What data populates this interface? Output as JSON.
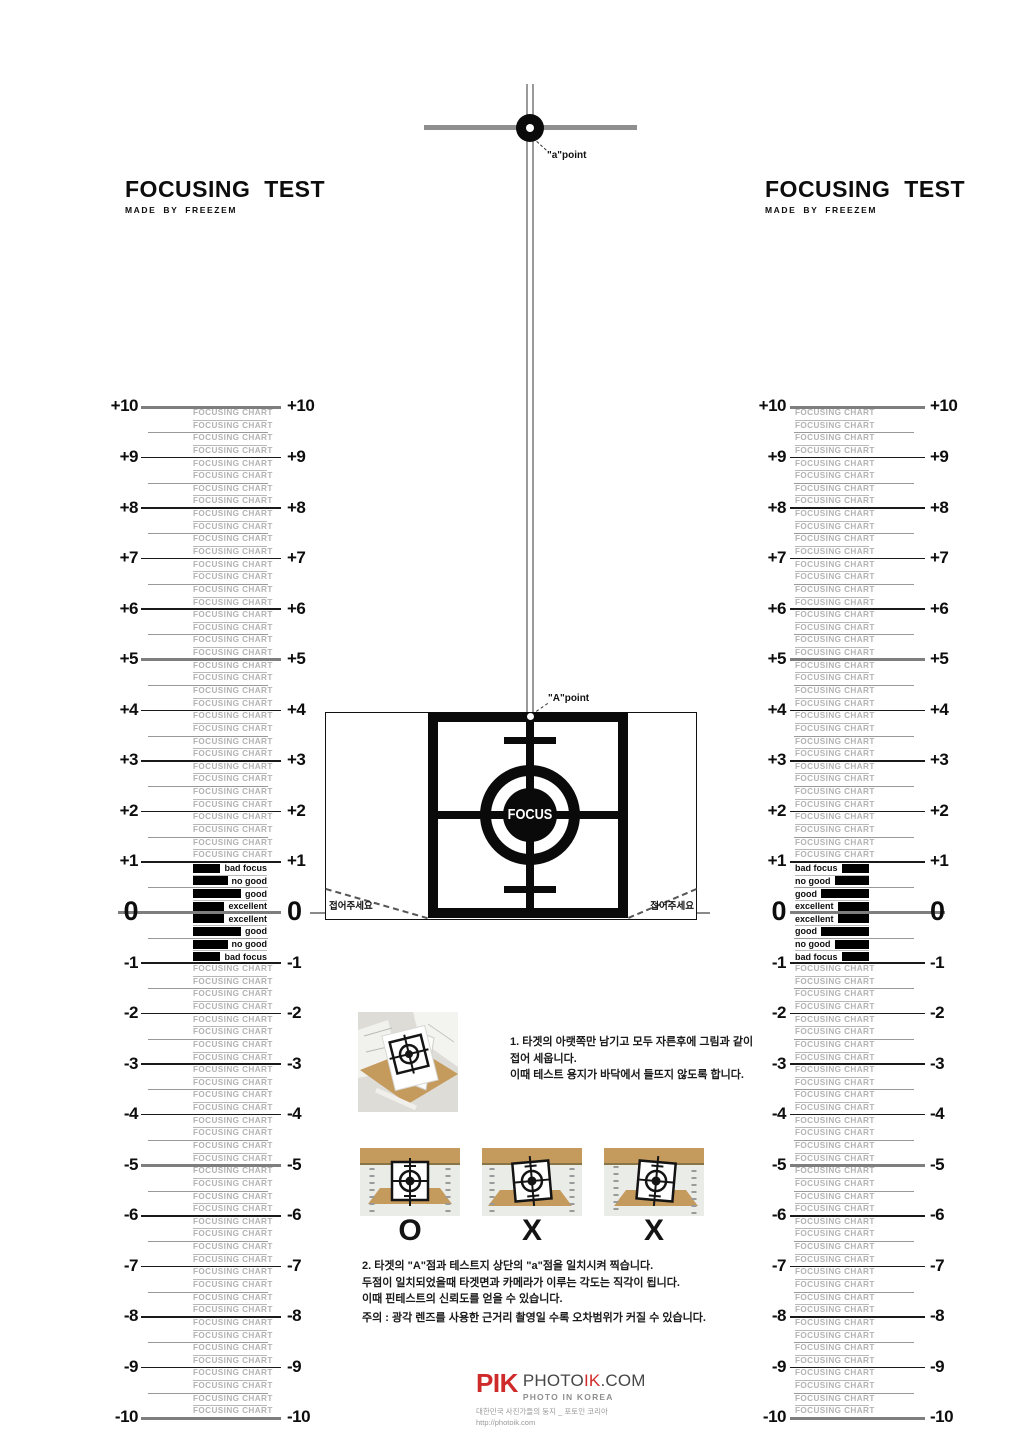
{
  "page": {
    "bg": "#ffffff"
  },
  "header_left": {
    "title": "FOCUSING TEST",
    "subtitle": "MADE BY FREEZEM"
  },
  "header_right": {
    "title": "FOCUSING TEST",
    "subtitle": "MADE BY FREEZEM"
  },
  "crosshair": {
    "label": "\"a\"point"
  },
  "target": {
    "a_point_label": "\"A\"point",
    "focus_label": "FOCUS",
    "fold_label_left": "접어주세요",
    "fold_label_right": "접어주세요"
  },
  "ruler": {
    "max": 10,
    "min": -10,
    "filler_text": "FOCUSING CHART",
    "zero_labels": [
      "bad focus",
      "no good",
      "good",
      "excellent",
      "excellent",
      "good",
      "no good",
      "bad focus"
    ]
  },
  "instructions": {
    "step1_lines": [
      "1. 타겟의 아랫쪽만 남기고 모두 자른후에 그림과 같이",
      "접어 세웁니다.",
      "이때 테스트 용지가 바닥에서 들뜨지 않도록 합니다."
    ],
    "step2_lines": [
      "2. 타겟의 \"A\"점과 테스트지 상단의 \"a\"점을 일치시켜 찍습니다.",
      "두점이 일치되었을때 타겟면과 카메라가 이루는 각도는 직각이 됩니다.",
      "이때 핀테스트의 신뢰도를 얻을 수 있습니다."
    ],
    "warning": "주의 : 광각 렌즈를 사용한 근거리 촬영일 수록 오차범위가 커질 수 있습니다."
  },
  "examples": {
    "labels": [
      "O",
      "X",
      "X"
    ]
  },
  "logo": {
    "pik": "PIK",
    "brand_prefix": "PHOTO",
    "brand_mid": "IK",
    "brand_suffix": ".COM",
    "tagline": "PHOTO IN KOREA",
    "desc": "대한민국 사진가들의 둥지 _ 포토인 코리아",
    "url": "http://photoik.com"
  },
  "colors": {
    "accent_red": "#cf2a2a",
    "thick_line_gray": "#7e7e7e",
    "filler_gray": "#b3b3b3"
  }
}
